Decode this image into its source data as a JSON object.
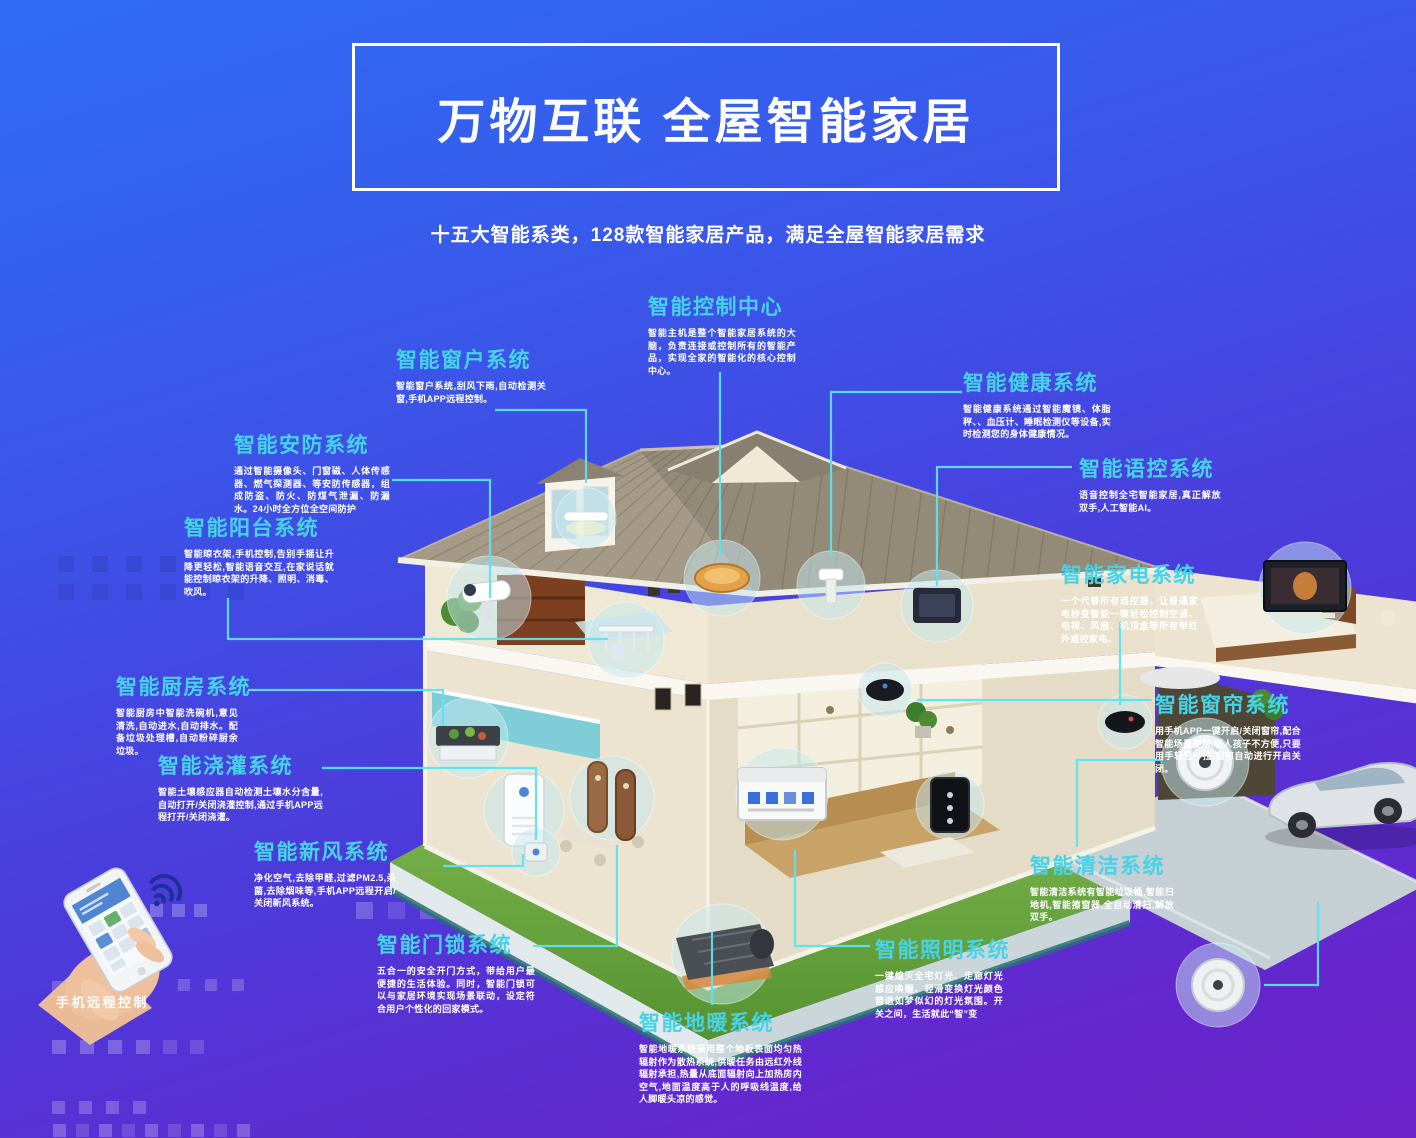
{
  "header": {
    "title": "万物互联 全屋智能家居",
    "subtitle": "十五大智能系类，128款智能家居产品，满足全屋智能家居需求"
  },
  "phone": {
    "caption": "手机远程控制"
  },
  "icons": {
    "wifi_icon": "wifi-signal"
  },
  "colors": {
    "accent_cyan": "#46d3e8",
    "connector": "#5ee2f0",
    "background_top": "#2e6df5",
    "background_bottom": "#6b22cb",
    "title_text": "#ffffff"
  },
  "systems": [
    {
      "key": "control-center",
      "title": "智能控制中心",
      "desc": "智能主机是整个智能家居系统的大脑，负责连接或控制所有的智能产品，实现全家的智能化的核心控制中心。"
    },
    {
      "key": "window",
      "title": "智能窗户系统",
      "desc": "智能窗户系统,刮风下雨,自动检测关窗,手机APP远程控制。"
    },
    {
      "key": "security",
      "title": "智能安防系统",
      "desc": "通过智能摄像头、门窗磁、人体传感器、燃气探测器、等安防传感器，组成防盗、防火、防煤气泄漏、防漏水。24小时全方位全空间防护"
    },
    {
      "key": "balcony",
      "title": "智能阳台系统",
      "desc": "智能晾衣架,手机控制,告别手摇让升降更轻松,智能语音交互,在家说话就能控制晾衣架的升降、照明、消毒、吹风。"
    },
    {
      "key": "kitchen",
      "title": "智能厨房系统",
      "desc": "智能厨房中智能洗碗机,意见清洗,自动进水,自动排水。配备垃圾处理槽,自动粉碎厨余垃圾。"
    },
    {
      "key": "irrigation",
      "title": "智能浇灌系统",
      "desc": "智能土壤感应器自动检测土壤水分含量,自动打开/关闭浇灌控制,通过手机APP远程打开/关闭浇灌。"
    },
    {
      "key": "fresh-air",
      "title": "智能新风系统",
      "desc": "净化空气,去除甲醛,过滤PM2.5,杀菌,去除烟味等,手机APP远程开启/关闭新风系统。"
    },
    {
      "key": "door-lock",
      "title": "智能门锁系统",
      "desc": "五合一的安全开门方式，带给用户最便捷的生活体验。同时，智能门锁可以与家居环境实现场景联动，设定符合用户个性化的回家模式。"
    },
    {
      "key": "floor-heating",
      "title": "智能地暖系统",
      "desc": "智能地暖系统采用整个地板表面均匀热辐射作为散热系统,供暖任务由远红外线辐射承担,热量从底面辐射向上加热房内空气,地面温度高于人的呼吸线温度,给人脚暖头凉的感觉。"
    },
    {
      "key": "lighting",
      "title": "智能照明系统",
      "desc": "一键熄灭全宅灯光、走廊灯光感应唤醒、轻滑变换灯光颜色营造如梦似幻的灯光氛围。开关之间，生活就此“智”变"
    },
    {
      "key": "cleaning",
      "title": "智能清洁系统",
      "desc": "智能清洁系统有智能垃圾桶,智能扫地机,智能擦窗器,全自动清扫,解放双手。"
    },
    {
      "key": "curtain",
      "title": "智能窗帘系统",
      "desc": "用手机APP一键开启/关闭窗帘,配合智能场景使用,老人孩子不方便,只要用手轻轻一拉,窗帘自动进行开启关闭。"
    },
    {
      "key": "appliance",
      "title": "智能家电系统",
      "desc": "一个代替所有遥控器，让普通家电秒变智能一键轻松控制空调、电视、风扇、机顶盒等所有带红外遥控家电。"
    },
    {
      "key": "voice",
      "title": "智能语控系统",
      "desc": "语音控制全宅智能家居,真正解放双手,人工智能AI。"
    },
    {
      "key": "health",
      "title": "智能健康系统",
      "desc": "智能健康系统通过智能魔镜、体脂秤、、血压计、睡眠检测仪等设备,实时检测您的身体健康情况。"
    }
  ]
}
